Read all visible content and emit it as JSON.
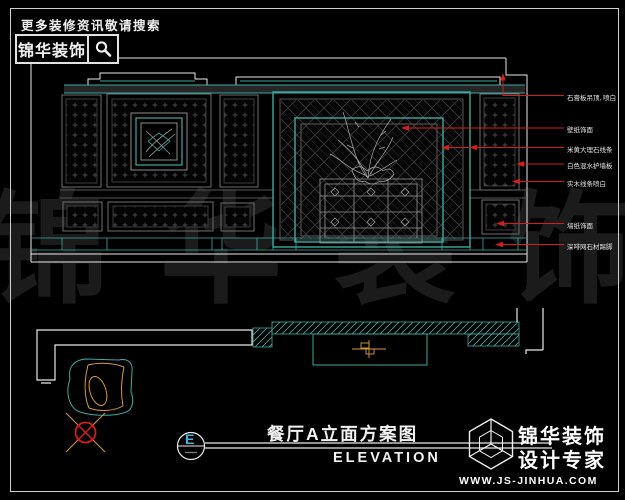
{
  "header": {
    "tagline": "更多装修资讯敬请搜索",
    "brand": "锦华装饰",
    "search_icon": "magnifier-icon"
  },
  "watermark": {
    "text": "锦华装饰"
  },
  "elevation": {
    "annotations": [
      {
        "text": "石膏板吊顶, 喷白"
      },
      {
        "text": "壁纸饰面"
      },
      {
        "text": "米黄大理石线条"
      },
      {
        "text": "白色混水护墙板"
      },
      {
        "text": "实木线条喷白"
      },
      {
        "text": "墙纸饰面"
      },
      {
        "text": "深啡网石材踢脚"
      }
    ]
  },
  "title_block": {
    "marker_letter": "E",
    "title": "餐厅A立面方案图",
    "subtitle": "ELEVATION"
  },
  "footer_logo": {
    "brand": "锦华装饰",
    "tagline": "设计专家",
    "website": "WWW.JS-JINHUA.COM",
    "cube_icon": "isometric-cube-icon"
  },
  "colors": {
    "teal_line": "#3fa9a0",
    "red_leader": "#d61c1c",
    "orange_line": "#d89a3c",
    "white_line": "#e9e9e9",
    "cyan_letter": "#46b7dc",
    "watermark_gray": "#1b1b1b"
  }
}
